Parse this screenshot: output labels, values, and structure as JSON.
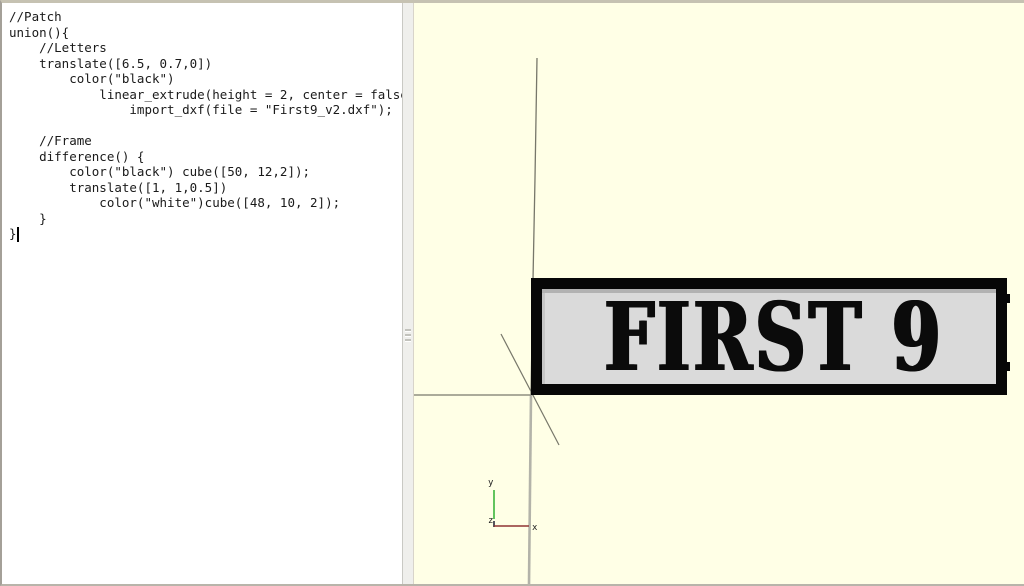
{
  "editor": {
    "code": "//Patch\nunion(){\n    //Letters\n    translate([6.5, 0.7,0])\n        color(\"black\")\n            linear_extrude(height = 2, center = false)\n                import_dxf(file = \"First9_v2.dxf\");\n\n    //Frame\n    difference() {\n        color(\"black\") cube([50, 12,2]);\n        translate([1, 1,0.5])\n            color(\"white\")cube([48, 10, 2]);\n    }\n}"
  },
  "viewport": {
    "background_color": "#ffffe6",
    "axis_line_color": "#7c7c6e",
    "patch": {
      "label": "FIRST 9",
      "frame_color": "#070707",
      "fill_color": "#dadada",
      "text_color": "#0b0b0b"
    },
    "gizmo": {
      "x_label": "x",
      "y_label": "y",
      "z_label": "z",
      "x_axis_color": "#8f3434",
      "y_axis_color": "#3cb53c",
      "z_axis_color": "#2a2a3a"
    }
  }
}
